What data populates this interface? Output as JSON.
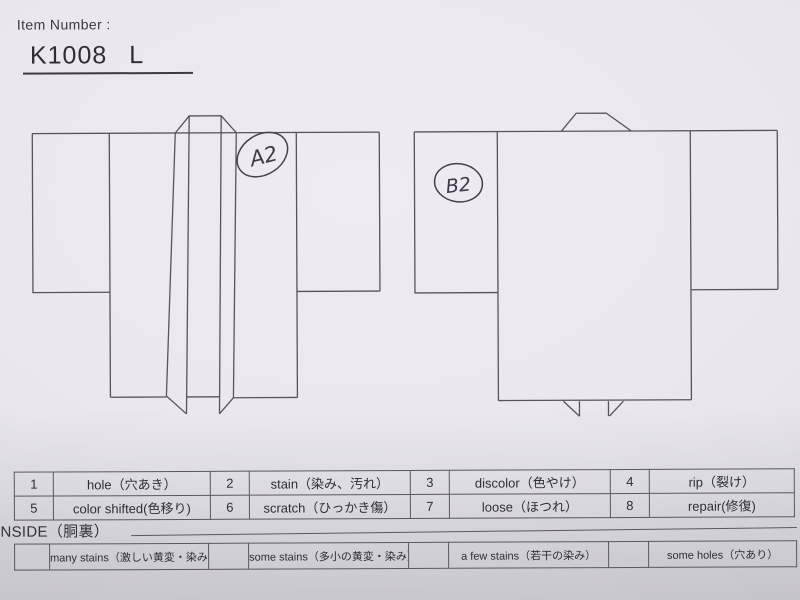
{
  "header": {
    "label": "Item Number :",
    "item_code": "K1008",
    "item_size": "L"
  },
  "annotations": {
    "front_mark": "A2",
    "back_mark": "B2"
  },
  "defect_table": {
    "items": [
      {
        "num": "1",
        "label": "hole（穴あき）"
      },
      {
        "num": "2",
        "label": "stain（染み、汚れ）"
      },
      {
        "num": "3",
        "label": "discolor（色やけ）"
      },
      {
        "num": "4",
        "label": "rip（裂け）"
      },
      {
        "num": "5",
        "label": "color shifted(色移り)"
      },
      {
        "num": "6",
        "label": "scratch（ひっかき傷）"
      },
      {
        "num": "7",
        "label": "loose（ほつれ）"
      },
      {
        "num": "8",
        "label": "repair(修復)"
      }
    ]
  },
  "inside_section": {
    "title": "INSIDE（胴裏）",
    "options": [
      {
        "label": "many stains（激しい黄変・染み）"
      },
      {
        "label": "some stains（多小の黄変・染み）"
      },
      {
        "label": "a few stains（若干の染み）"
      },
      {
        "label": "some holes（穴あり）"
      }
    ]
  },
  "colors": {
    "paper": "#e9e7ed",
    "diagram_line": "#56535f",
    "print_ink": "#2f2d36",
    "handwriting_ink": "#3f3b47"
  }
}
